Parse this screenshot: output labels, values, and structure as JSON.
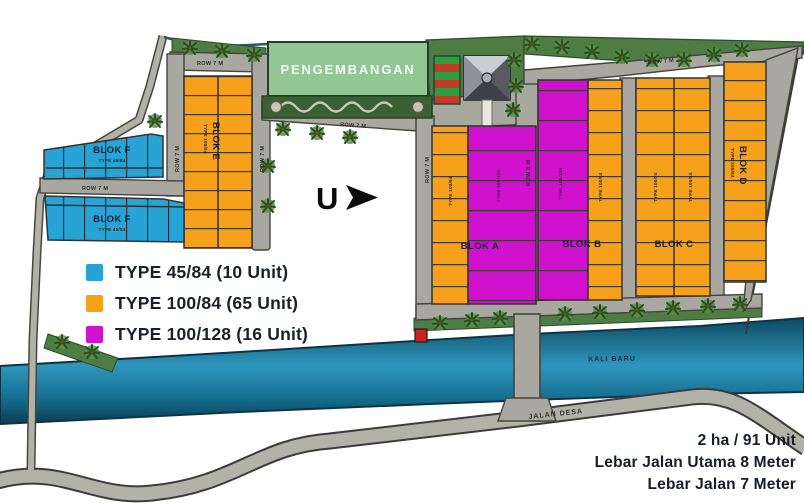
{
  "map": {
    "development_label": "PENGEMBANGAN",
    "river_label": "KALI BARU",
    "village_road_label": "JALAN DESA",
    "road_row_7": "ROW 7 M",
    "road_row_8": "ROW 8 M",
    "north_label": "U"
  },
  "blocks": {
    "a": {
      "name": "BLOK A",
      "left_type": "TYPE 100/84",
      "right_type": "TYPE 100/128"
    },
    "b": {
      "name": "BLOK B",
      "left_type": "TYPE 100/128",
      "right_type": "TYPE 100/84"
    },
    "c": {
      "name": "BLOK C",
      "left_type": "TYPE 100/84",
      "right_type": "TYPE 100/84"
    },
    "d": {
      "name": "BLOK D",
      "type": "TYPE 100/84"
    },
    "e": {
      "name": "BLOK E",
      "type": "TYPE 100/84"
    },
    "f_north": {
      "name": "BLOK F",
      "type": "TYPE 45/84"
    },
    "f_south": {
      "name": "BLOK F",
      "type": "TYPE 45/84"
    }
  },
  "legend": {
    "items": [
      {
        "label": "TYPE 45/84 (10 Unit)",
        "color": "#28a3d6"
      },
      {
        "label": "TYPE 100/84 (65 Unit)",
        "color": "#f6a01b"
      },
      {
        "label": "TYPE 100/128 (16 Unit)",
        "color": "#d012ce"
      }
    ]
  },
  "summary": {
    "line1": "2 ha / 91 Unit",
    "line2": "Lebar Jalan Utama 8 Meter",
    "line3": "Lebar Jalan 7 Meter"
  },
  "colors": {
    "type_45_84": "#28a3d6",
    "type_100_84": "#f6a01b",
    "type_100_128": "#d012ce",
    "road": "#a9a8a0",
    "river": "#1b7396",
    "green_area": "#4e7d43",
    "text_dark": "#1a1f29"
  }
}
